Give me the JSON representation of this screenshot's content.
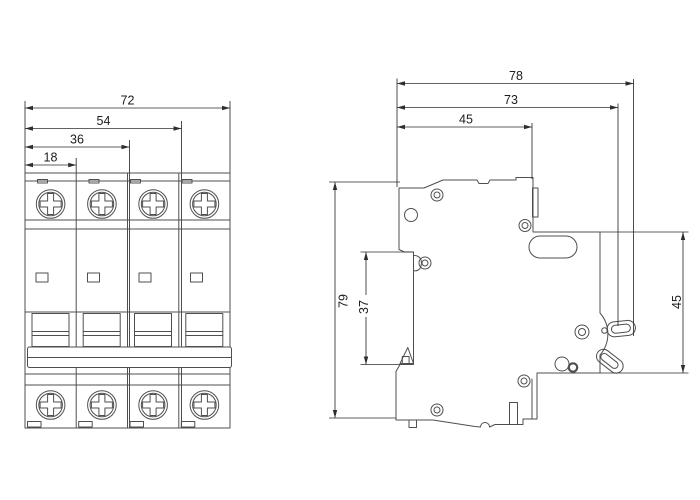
{
  "drawing": {
    "kind": "technical-dimension-drawing",
    "subject": "4-pole miniature circuit breaker, front and side outline views",
    "colors": {
      "background": "#ffffff",
      "outline": "#4f4f4f",
      "dimension_lines": "#2e2e2e",
      "dimension_text": "#1c1c1c"
    }
  },
  "front_view": {
    "dimensions": {
      "overall_width": "72",
      "width_three_modules": "54",
      "width_two_modules": "36",
      "width_one_module": "18"
    }
  },
  "side_view": {
    "dimensions": {
      "overall_depth": "78",
      "depth_to_handle": "73",
      "top_depth": "45",
      "overall_height": "79",
      "rail_recess_height": "37",
      "front_face_height": "45"
    }
  }
}
